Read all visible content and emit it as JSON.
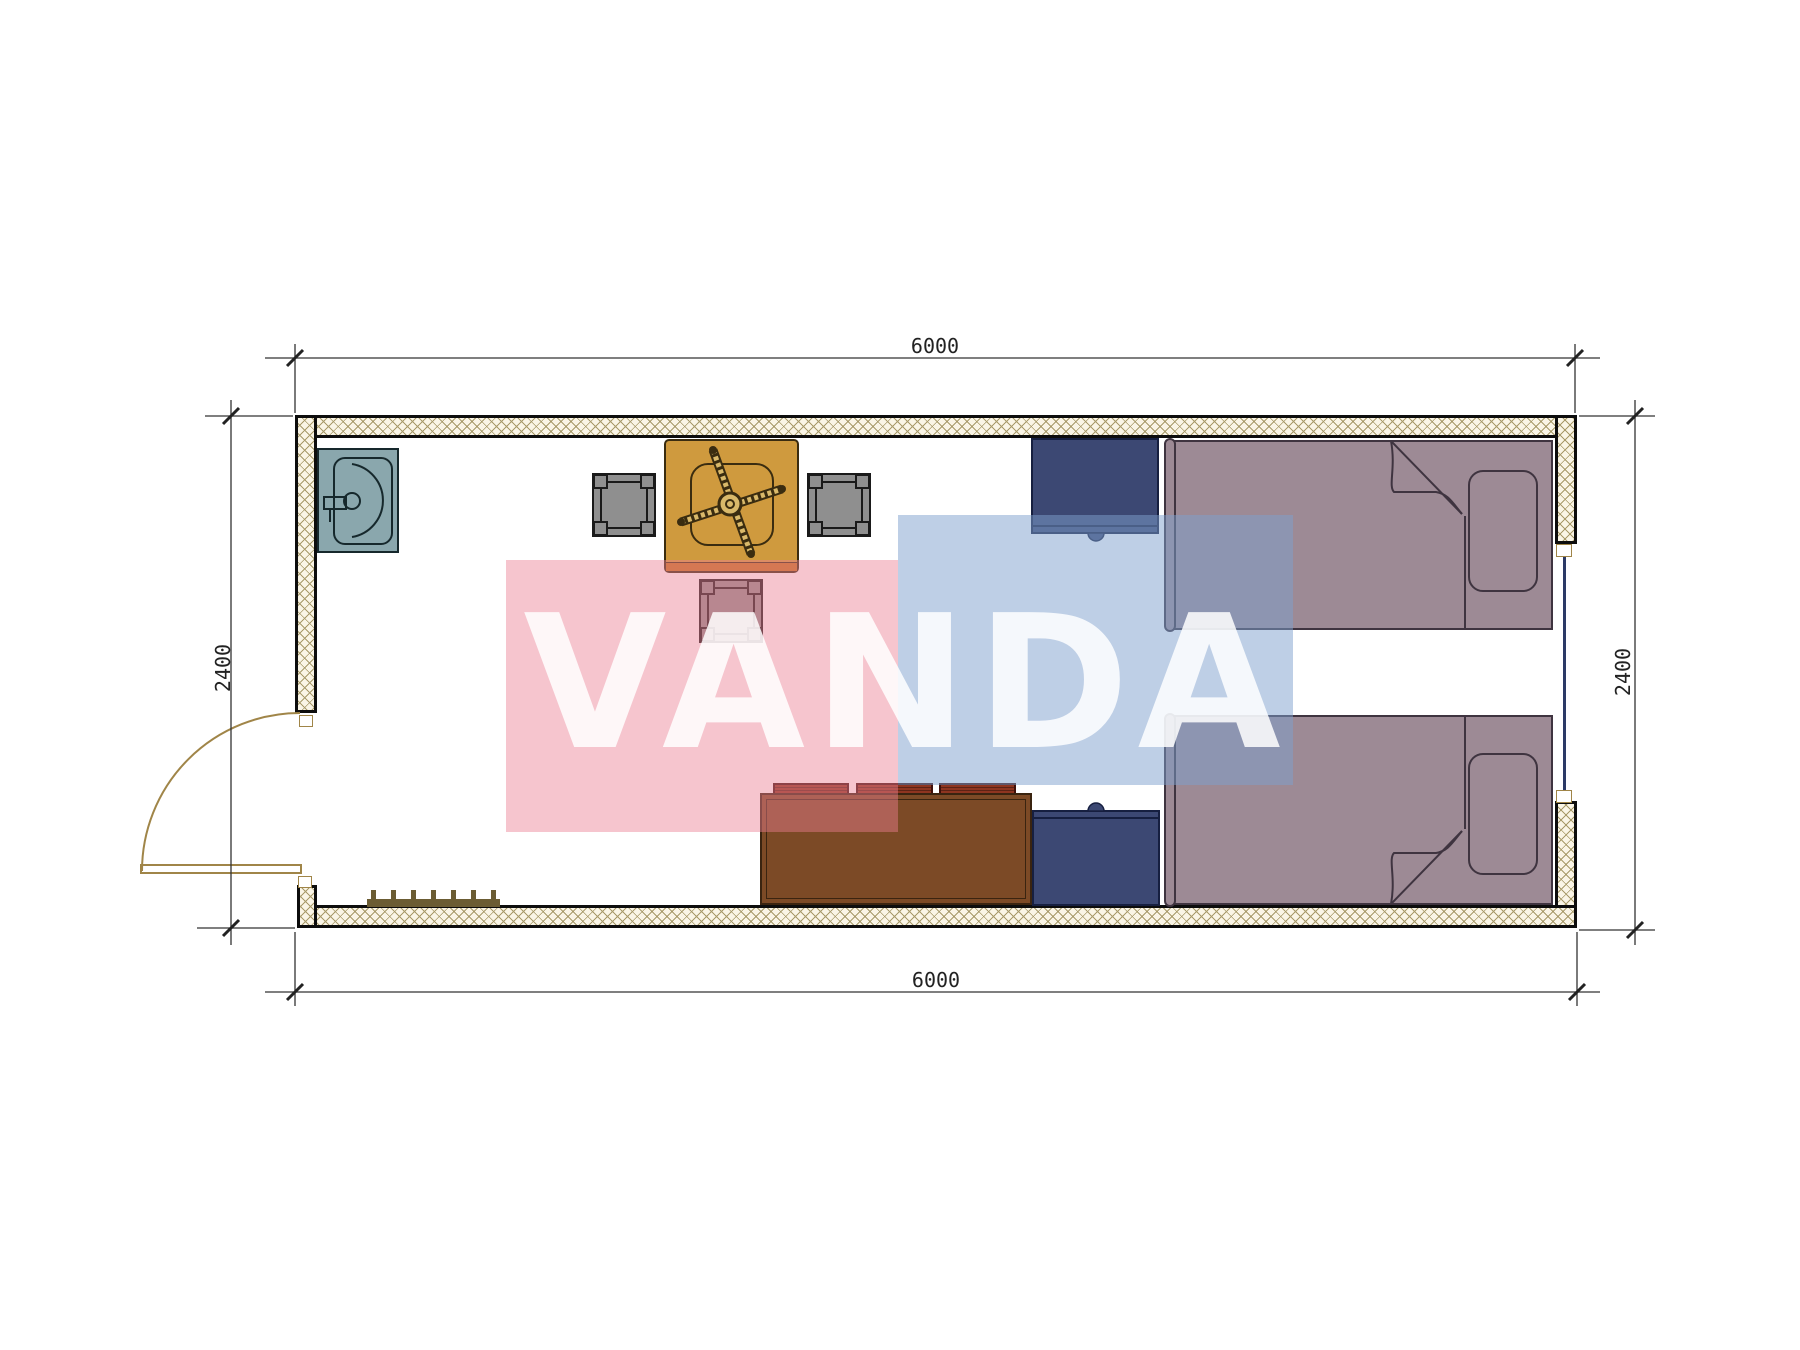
{
  "document": {
    "type": "architectural floor plan, 6000 x 2400 container room"
  },
  "watermark": {
    "text": "VANDA"
  },
  "dimensions": {
    "top": "6000",
    "bottom": "6000",
    "left": "2400",
    "right": "2400"
  },
  "colors": {
    "wall-hatch-bg": "#faf5e6",
    "wall-hatch-line": "#a89a6a",
    "wall-edge": "#0d0d0d",
    "dim-line": "#333333",
    "dim-text": "#222222",
    "sink-fill": "#8aa7ad",
    "sink-line": "#16282c",
    "table-fill": "#cf9a3e",
    "table-shadow": "#c4731f",
    "table-line": "#3a2c10",
    "table-base": "#d9b96a",
    "chair-fill": "#8f8f8f",
    "chair-line": "#1a1a1a",
    "bed-fill": "#9d8a95",
    "bed-line": "#3f3440",
    "nightstand-fill": "#3c4873",
    "nightstand-line": "#161f40",
    "sofa-fill": "#7c4a26",
    "sofa-line": "#3a2410",
    "cushion-fill": "#8e3520",
    "door-line": "#a08548",
    "window-line": "#2c3a66",
    "radiator-fill": "#6b5c33",
    "watermark-pink": "rgba(236,126,146,0.45)",
    "watermark-blue": "rgba(125,160,206,0.50)",
    "watermark-text": "rgba(255,255,255,0.85)"
  }
}
